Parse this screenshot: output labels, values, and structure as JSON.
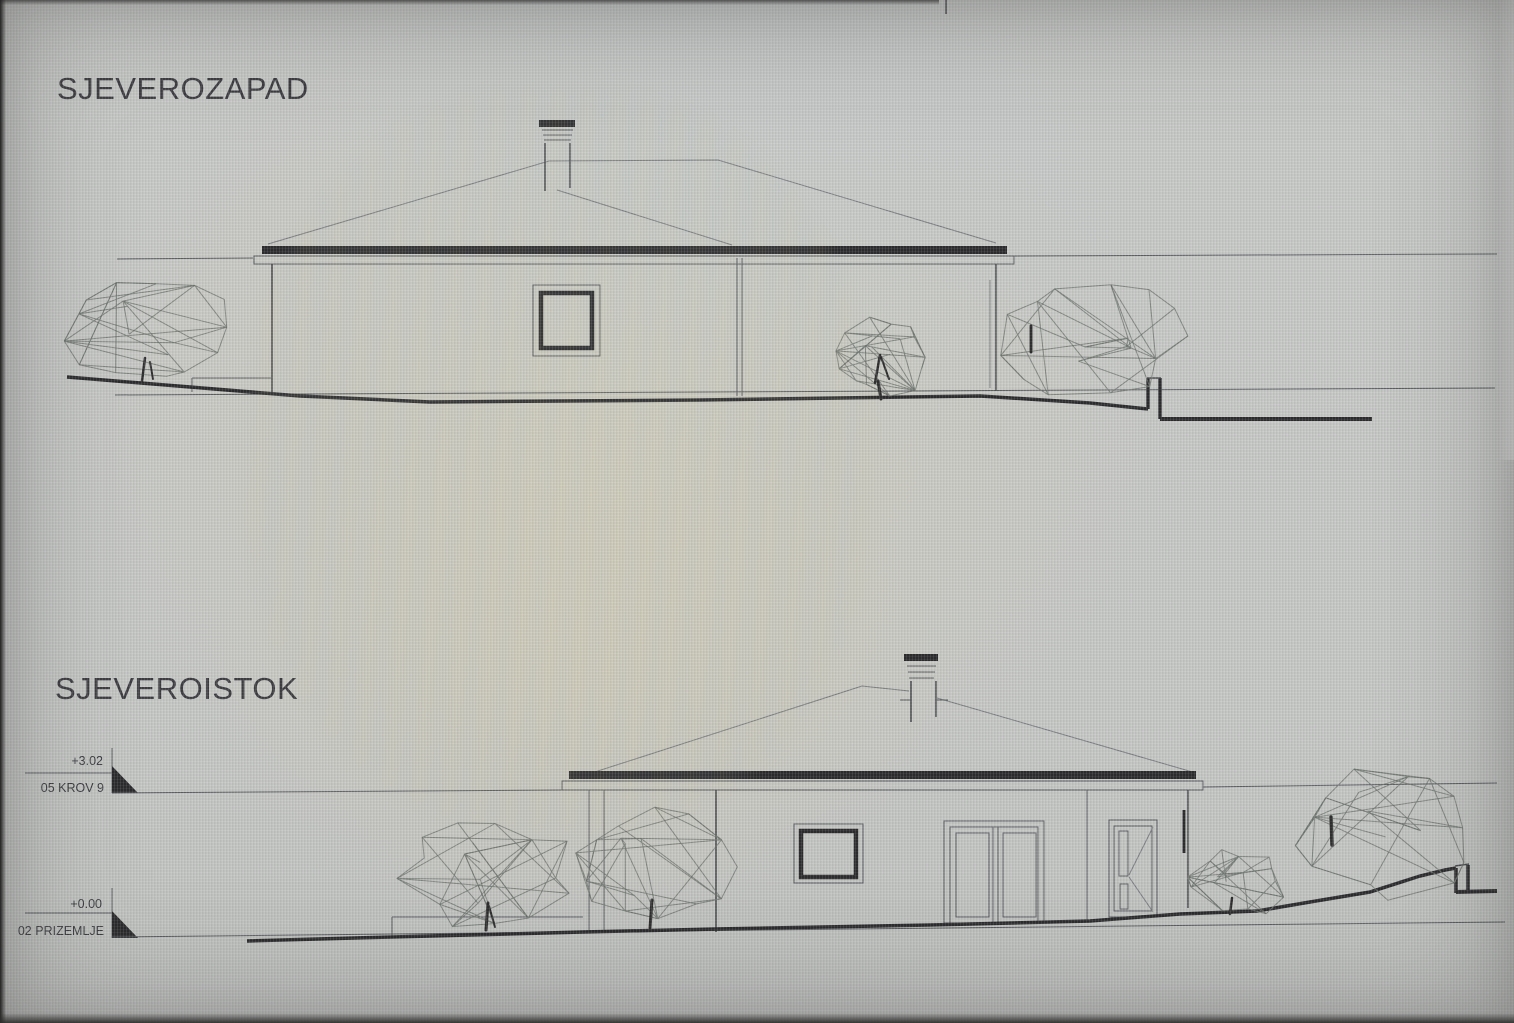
{
  "screen": {
    "top_elevation": {
      "title": "SJEVEROZAPAD"
    },
    "bottom_elevation": {
      "title": "SJEVEROISTOK",
      "markers": [
        {
          "value": "+3.02",
          "label": "05 KROV 9"
        },
        {
          "value": "+0.00",
          "label": "02 PRIZEMLJE"
        }
      ]
    },
    "colors": {
      "ink_heavy": "#2c2c2e",
      "line": "#5c5e62",
      "roof_faint": "#7c7e82",
      "tree_line": "#70756f",
      "background": "#c6c8c6"
    }
  }
}
